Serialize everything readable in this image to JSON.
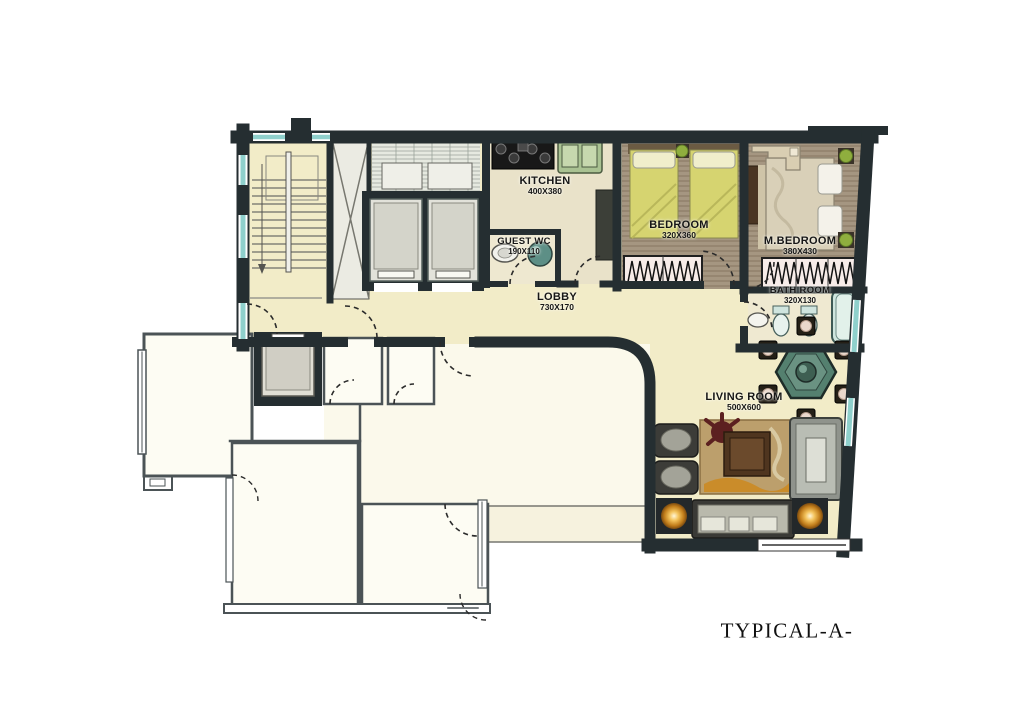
{
  "plan": {
    "title": "TYPICAL-A-",
    "rooms": {
      "kitchen": {
        "name": "KITCHEN",
        "dims": "400X380"
      },
      "guest_wc": {
        "name": "GUEST WC",
        "dims": "190X110"
      },
      "bedroom": {
        "name": "BEDROOM",
        "dims": "320X360"
      },
      "master_bedroom": {
        "name": "M.BEDROOM",
        "dims": "380X430"
      },
      "lobby": {
        "name": "LOBBY",
        "dims": "730X170"
      },
      "bath_room": {
        "name": "BATH ROOM",
        "dims": "320X130"
      },
      "living_room": {
        "name": "LIVING ROOM",
        "dims": "500X600"
      }
    },
    "colors": {
      "wall": "#252e31",
      "floor_cream": "#f2ecc8",
      "floor_wood": "#a59681",
      "floor_white": "#fdfcf3",
      "window": "#8fd0cc",
      "table_teal": "#54806f",
      "lamp_glow": "#e9a23b"
    }
  }
}
